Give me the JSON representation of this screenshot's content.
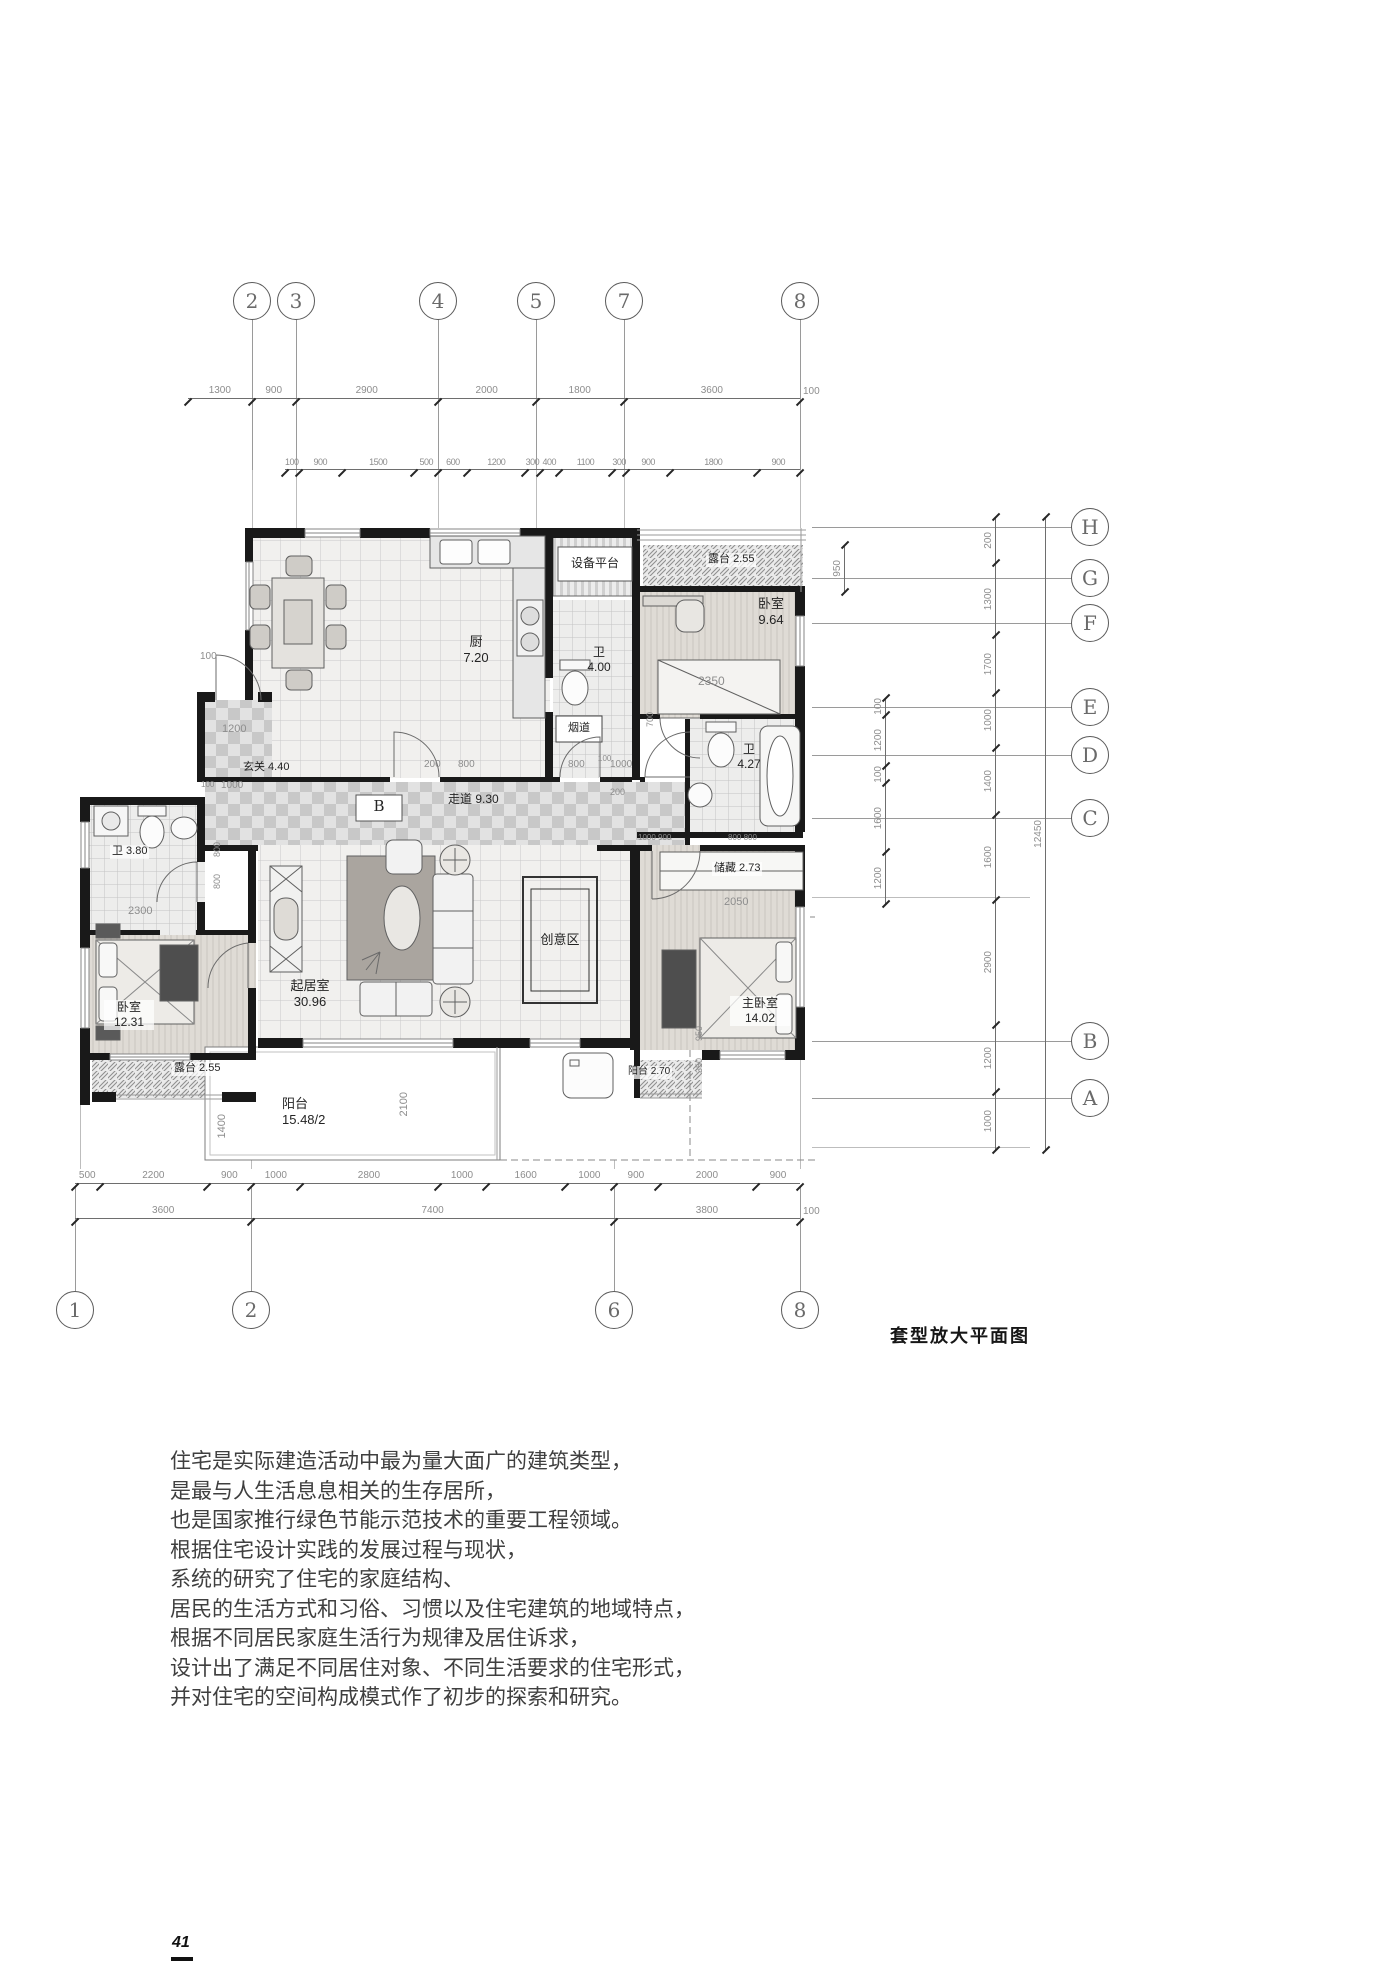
{
  "doc": {
    "page_number": "41",
    "caption": "套型放大平面图"
  },
  "paragraph": [
    "住宅是实际建造活动中最为量大面广的建筑类型，",
    "是最与人生活息息相关的生存居所，",
    "也是国家推行绿色节能示范技术的重要工程领域。",
    "根据住宅设计实践的发展过程与现状，",
    "系统的研究了住宅的家庭结构、",
    "居民的生活方式和习俗、习惯以及住宅建筑的地域特点，",
    "根据不同居民家庭生活行为规律及居住诉求，",
    "设计出了满足不同居住对象、不同生活要求的住宅形式，",
    "并对住宅的空间构成模式作了初步的探索和研究。"
  ],
  "grid": {
    "top": [
      "2",
      "3",
      "4",
      "5",
      "7",
      "8"
    ],
    "bottom": [
      "1",
      "2",
      "6",
      "8"
    ],
    "right": [
      "H",
      "G",
      "F",
      "E",
      "D",
      "C",
      "B",
      "A"
    ]
  },
  "dims": {
    "top1": [
      {
        "v": "1300",
        "w": 1300
      },
      {
        "v": "900",
        "w": 900
      },
      {
        "v": "2900",
        "w": 2900
      },
      {
        "v": "2000",
        "w": 2000
      },
      {
        "v": "1800",
        "w": 1800
      },
      {
        "v": "3600",
        "w": 3600
      }
    ],
    "top1_tail": "100",
    "top2": [
      {
        "v": "100",
        "w": 100
      },
      {
        "v": "900",
        "w": 900
      },
      {
        "v": "1500",
        "w": 1500
      },
      {
        "v": "500",
        "w": 500
      },
      {
        "v": "600",
        "w": 600
      },
      {
        "v": "1200",
        "w": 1200
      },
      {
        "v": "300",
        "w": 300
      },
      {
        "v": "400",
        "w": 400
      },
      {
        "v": "1100",
        "w": 1100
      },
      {
        "v": "300",
        "w": 300
      },
      {
        "v": "900",
        "w": 900
      },
      {
        "v": "1800",
        "w": 1800
      },
      {
        "v": "900",
        "w": 900
      }
    ],
    "bottom1": [
      {
        "v": "500",
        "w": 500
      },
      {
        "v": "2200",
        "w": 2200
      },
      {
        "v": "900",
        "w": 900
      },
      {
        "v": "1000",
        "w": 1000
      },
      {
        "v": "2800",
        "w": 2800
      },
      {
        "v": "1000",
        "w": 1000
      },
      {
        "v": "1600",
        "w": 1600
      },
      {
        "v": "1000",
        "w": 1000
      },
      {
        "v": "900",
        "w": 900
      },
      {
        "v": "2000",
        "w": 2000
      },
      {
        "v": "900",
        "w": 900
      }
    ],
    "bottom2": [
      {
        "v": "3600",
        "w": 3600
      },
      {
        "v": "7400",
        "w": 7400
      },
      {
        "v": "3800",
        "w": 3800
      }
    ],
    "bottom2_tail": "100",
    "right_outer": [
      {
        "v": "200",
        "w": 46
      },
      {
        "v": "1300",
        "w": 72
      },
      {
        "v": "1700",
        "w": 58
      },
      {
        "v": "1000",
        "w": 55
      },
      {
        "v": "1400",
        "w": 67
      },
      {
        "v": "1600",
        "w": 85
      },
      {
        "v": "2900",
        "w": 125
      },
      {
        "v": "1200",
        "w": 67
      },
      {
        "v": "1000",
        "w": 58
      }
    ],
    "right_total": [
      {
        "v": "12450",
        "w": 1
      }
    ],
    "right_inner": [
      {
        "v": "100",
        "w": 100
      },
      {
        "v": "1200",
        "w": 1200
      },
      {
        "v": "100",
        "w": 100
      },
      {
        "v": "1600",
        "w": 1600
      },
      {
        "v": "1200",
        "w": 1200
      }
    ],
    "terrace_950": [
      {
        "v": "950",
        "w": 1
      }
    ]
  },
  "rooms": {
    "equip": {
      "name": "设备平台"
    },
    "terrace_top": {
      "name": "露台",
      "area": "2.55"
    },
    "bed2": {
      "name": "卧室",
      "area": "9.64"
    },
    "bath2": {
      "name": "卫",
      "area": "4.27"
    },
    "kitchen": {
      "name": "厨",
      "area": "7.20"
    },
    "bath_small": {
      "name": "卫",
      "area": "4.00"
    },
    "flue": {
      "name": "烟道"
    },
    "foyer": {
      "name": "玄关 4.40"
    },
    "corridor": {
      "name": "走道 9.30"
    },
    "b_mark": "B",
    "bath3": {
      "name": "卫 3.80"
    },
    "bed1": {
      "name": "卧室",
      "area": "12.31"
    },
    "terrace_left": {
      "name": "露台 2.55"
    },
    "living": {
      "name": "起居室",
      "area": "30.96"
    },
    "creative": {
      "name": "创意区"
    },
    "storage": {
      "name": "储藏 2.73"
    },
    "master": {
      "name": "主卧室",
      "area": "14.02"
    },
    "balcony_small": {
      "name": "阳台 2.70"
    },
    "balcony": {
      "name": "阳台",
      "area": "15.48/2"
    }
  },
  "plan_dims": {
    "entry_100": "100",
    "foyer_1200": "1200",
    "foyer_100": "100",
    "foyer_1000": "1000",
    "corr_200a": "200",
    "corr_800a": "800",
    "corr_800b": "800",
    "corr_100": "100",
    "corr_1000": "1000",
    "corr_200b": "200",
    "corr_700": "700",
    "corr_row2a": "1000 900",
    "corr_row2b": "800 800",
    "liv_800a": "800",
    "liv_800b": "800",
    "bed1_2300": "2300",
    "bed2_2350": "2350",
    "master_2050": "2050",
    "master_950": "950",
    "master_350": "350",
    "balcony_2100": "2100",
    "left_1400": "1400"
  }
}
